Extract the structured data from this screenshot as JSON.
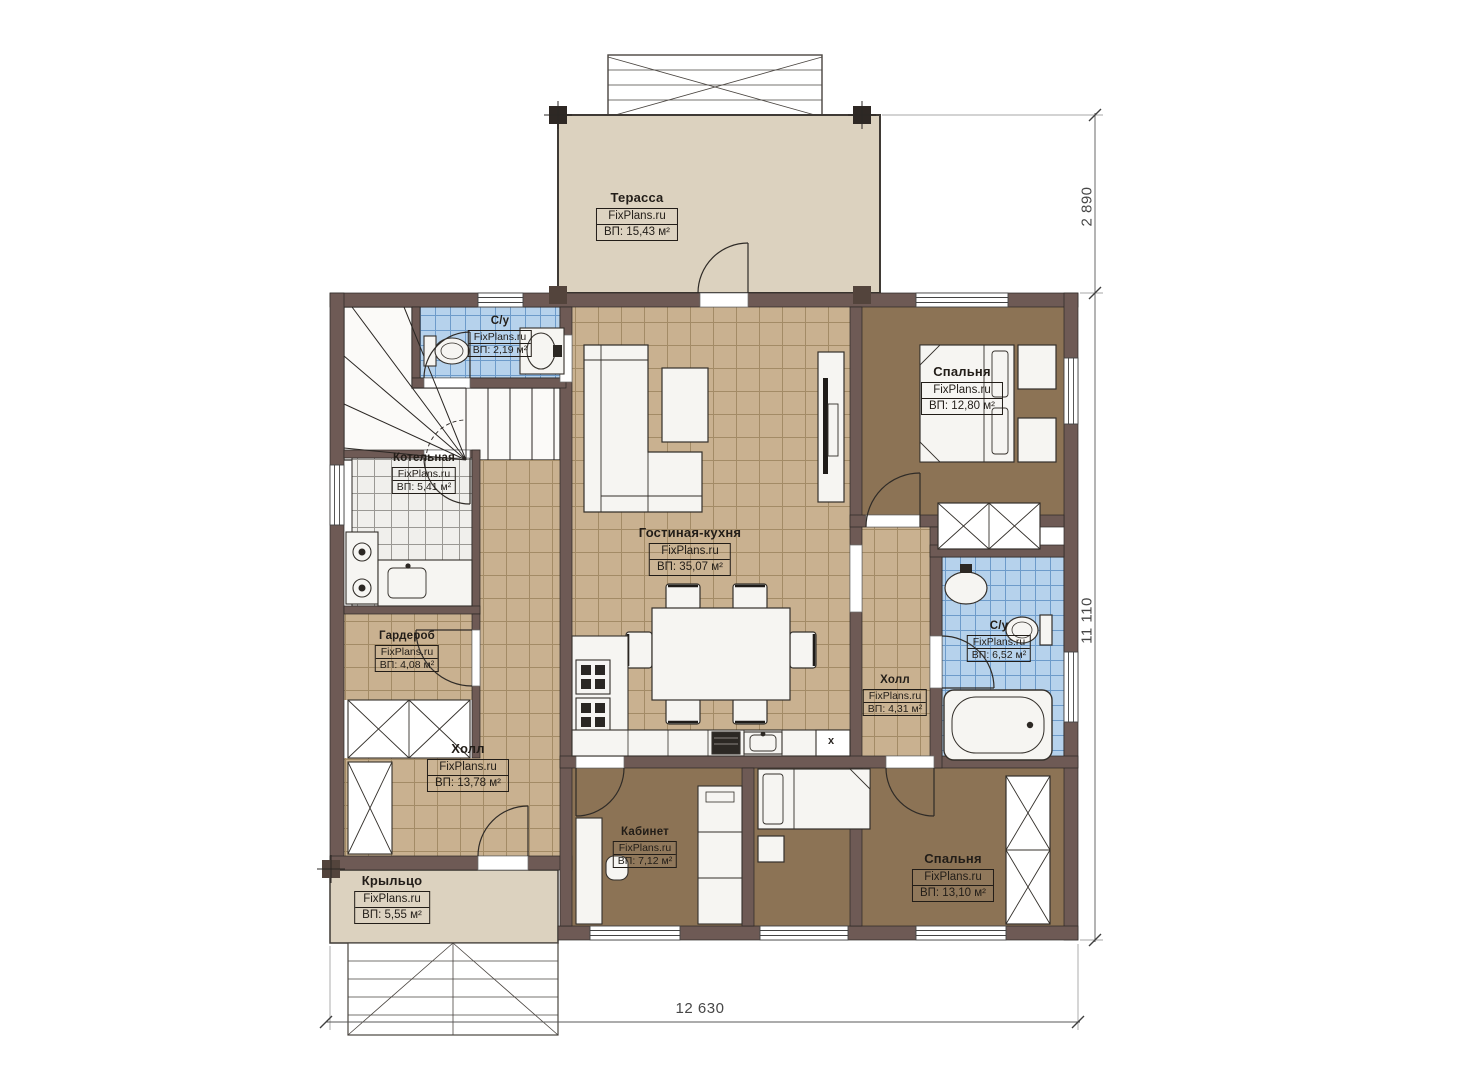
{
  "plan": {
    "brand": "FixPlans.ru",
    "type_label": "floor-plan"
  },
  "rooms": [
    {
      "id": "terrace",
      "name": "Терасса",
      "brand": "FixPlans.ru",
      "area": "ВП: 15,43 м²"
    },
    {
      "id": "wc-top",
      "name": "С/у",
      "brand": "FixPlans.ru",
      "area": "ВП: 2,19 м²"
    },
    {
      "id": "boiler",
      "name": "Котельная",
      "brand": "FixPlans.ru",
      "area": "ВП: 5,41 м²"
    },
    {
      "id": "bedroom-top",
      "name": "Спальня",
      "brand": "FixPlans.ru",
      "area": "ВП: 12,80 м²"
    },
    {
      "id": "living-kitchen",
      "name": "Гостиная-кухня",
      "brand": "FixPlans.ru",
      "area": "ВП: 35,07 м²"
    },
    {
      "id": "wardrobe",
      "name": "Гардероб",
      "brand": "FixPlans.ru",
      "area": "ВП: 4,08 м²"
    },
    {
      "id": "hall-main",
      "name": "Холл",
      "brand": "FixPlans.ru",
      "area": "ВП: 13,78 м²"
    },
    {
      "id": "wc-right",
      "name": "С/у",
      "brand": "FixPlans.ru",
      "area": "ВП: 6,52 м²"
    },
    {
      "id": "hall-small",
      "name": "Холл",
      "brand": "FixPlans.ru",
      "area": "ВП: 4,31 м²"
    },
    {
      "id": "office",
      "name": "Кабинет",
      "brand": "FixPlans.ru",
      "area": "ВП: 7,12 м²"
    },
    {
      "id": "bedroom-bottom",
      "name": "Спальня",
      "brand": "FixPlans.ru",
      "area": "ВП: 13,10 м²"
    },
    {
      "id": "porch",
      "name": "Крыльцо",
      "brand": "FixPlans.ru",
      "area": "ВП: 5,55 м²"
    }
  ],
  "dimensions": {
    "right_top": "2 890",
    "right_main": "11 110",
    "bottom": "12 630"
  },
  "annotations": {
    "washer_mark": "x"
  },
  "colors": {
    "wall": "#6e5a55",
    "tile_floor": "#c9b190",
    "bathroom_tile": "#b6d2ec",
    "bedroom_floor": "#8c7355",
    "terrace_floor": "#dcd2bf",
    "line": "#2b2724"
  }
}
